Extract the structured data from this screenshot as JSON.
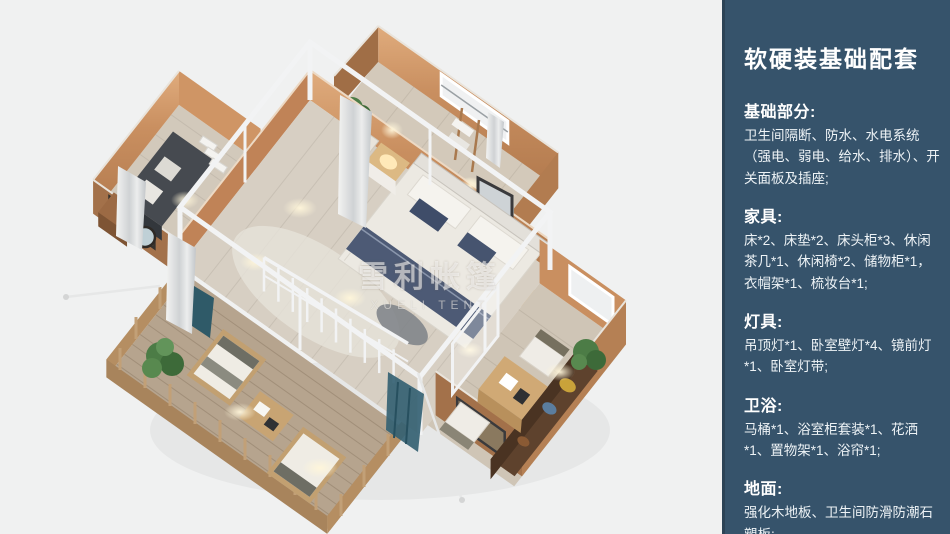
{
  "page": {
    "background": "#f0f1f1",
    "accent_colors": {
      "sidebar_background": "#36536b",
      "sidebar_text": "#ffffff",
      "tent_wall_tan": "#b98058",
      "bed_runner_navy": "#4d5a75",
      "wood_floor": "#d7cfc3"
    }
  },
  "render": {
    "description-of-scene": "3d-birdseye-floorplan-of-glamping-tent",
    "watermark": {
      "cn": "雪利帐篷",
      "en": "XUELI TENT"
    }
  },
  "sidebar": {
    "title": "软硬装基础配套",
    "sections": [
      {
        "heading": "基础部分:",
        "body": "卫生间隔断、防水、水电系统（强电、弱电、给水、排水）、开关面板及插座;"
      },
      {
        "heading": "家具:",
        "body": "床*2、床垫*2、床头柜*3、休闲茶几*1、休闲椅*2、储物柜*1，衣帽架*1、梳妆台*1;"
      },
      {
        "heading": "灯具:",
        "body": "吊顶灯*1、卧室壁灯*4、镜前灯*1、卧室灯带;"
      },
      {
        "heading": "卫浴:",
        "body": "马桶*1、浴室柜套装*1、花洒*1、置物架*1、浴帘*1;"
      },
      {
        "heading": "地面:",
        "body": "强化木地板、卫生间防滑防潮石塑板;"
      }
    ]
  }
}
